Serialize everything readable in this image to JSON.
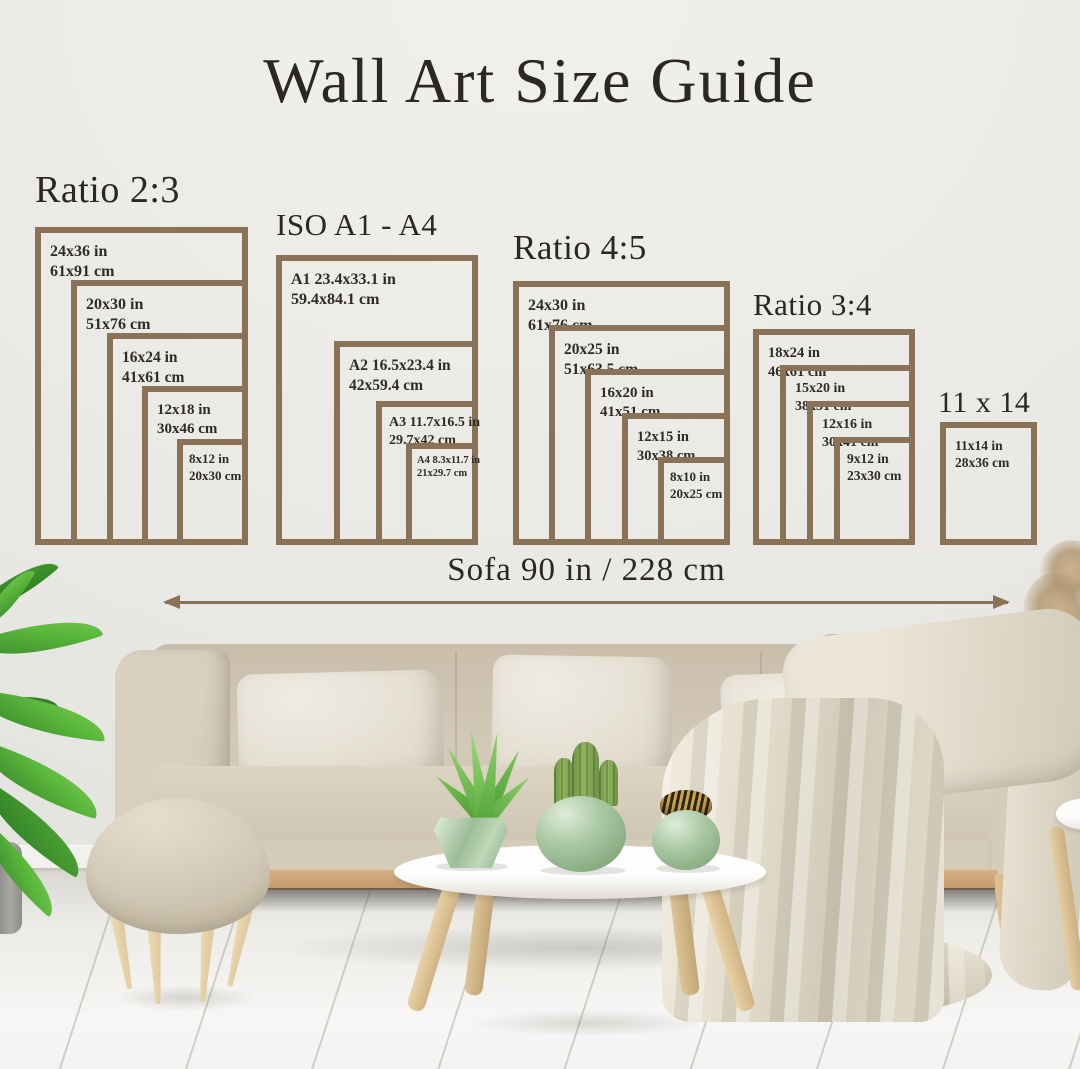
{
  "title": "Wall Art Size Guide",
  "sofa_measurement": {
    "label": "Sofa 90 in / 228 cm"
  },
  "groups": [
    {
      "label": "Ratio 2:3",
      "frames": [
        {
          "inches": "24x36 in",
          "cm": "61x91 cm"
        },
        {
          "inches": "20x30 in",
          "cm": "51x76 cm"
        },
        {
          "inches": "16x24 in",
          "cm": "41x61 cm"
        },
        {
          "inches": "12x18 in",
          "cm": "30x46 cm"
        },
        {
          "inches": "8x12 in",
          "cm": "20x30 cm"
        }
      ]
    },
    {
      "label": "ISO A1 - A4",
      "frames": [
        {
          "inches": "A1 23.4x33.1 in",
          "cm": "59.4x84.1 cm"
        },
        {
          "inches": "A2 16.5x23.4 in",
          "cm": "42x59.4 cm"
        },
        {
          "inches": "A3 11.7x16.5 in",
          "cm": "29.7x42 cm"
        },
        {
          "inches": "A4 8.3x11.7 in",
          "cm": "21x29.7 cm"
        }
      ]
    },
    {
      "label": "Ratio 4:5",
      "frames": [
        {
          "inches": "24x30 in",
          "cm": "61x76 cm"
        },
        {
          "inches": "20x25 in",
          "cm": "51x63.5 cm"
        },
        {
          "inches": "16x20 in",
          "cm": "41x51 cm"
        },
        {
          "inches": "12x15 in",
          "cm": "30x38 cm"
        },
        {
          "inches": "8x10 in",
          "cm": "20x25 cm"
        }
      ]
    },
    {
      "label": "Ratio 3:4",
      "frames": [
        {
          "inches": "18x24 in",
          "cm": "46x61 cm"
        },
        {
          "inches": "15x20 in",
          "cm": "38x51 cm"
        },
        {
          "inches": "12x16 in",
          "cm": "30x41 cm"
        },
        {
          "inches": "9x12 in",
          "cm": "23x30 cm"
        }
      ]
    },
    {
      "label": "11 x 14",
      "frames": [
        {
          "inches": "11x14 in",
          "cm": "28x36 cm"
        }
      ]
    }
  ],
  "colors": {
    "frame_border": "#8a7257",
    "text": "#2e2a24",
    "arrow": "#8a7257",
    "wall": "#e9e8e4",
    "floor": "#f6f5f3",
    "sofa": "#d0c6b4",
    "pillow": "#e7e2d8",
    "blanket": "#ded7c6",
    "pot_green": "#a9c6a2",
    "wood": "#dcc094",
    "plant_green": "#4ea83a"
  },
  "scene": {
    "items": [
      "potted-plant",
      "sofa",
      "pillows",
      "throw-blanket",
      "ottoman",
      "coffee-table",
      "aloe-plant-pot",
      "cactus-pot",
      "striped-ball-pot",
      "pampas-grass",
      "side-table",
      "wood-floor"
    ]
  }
}
